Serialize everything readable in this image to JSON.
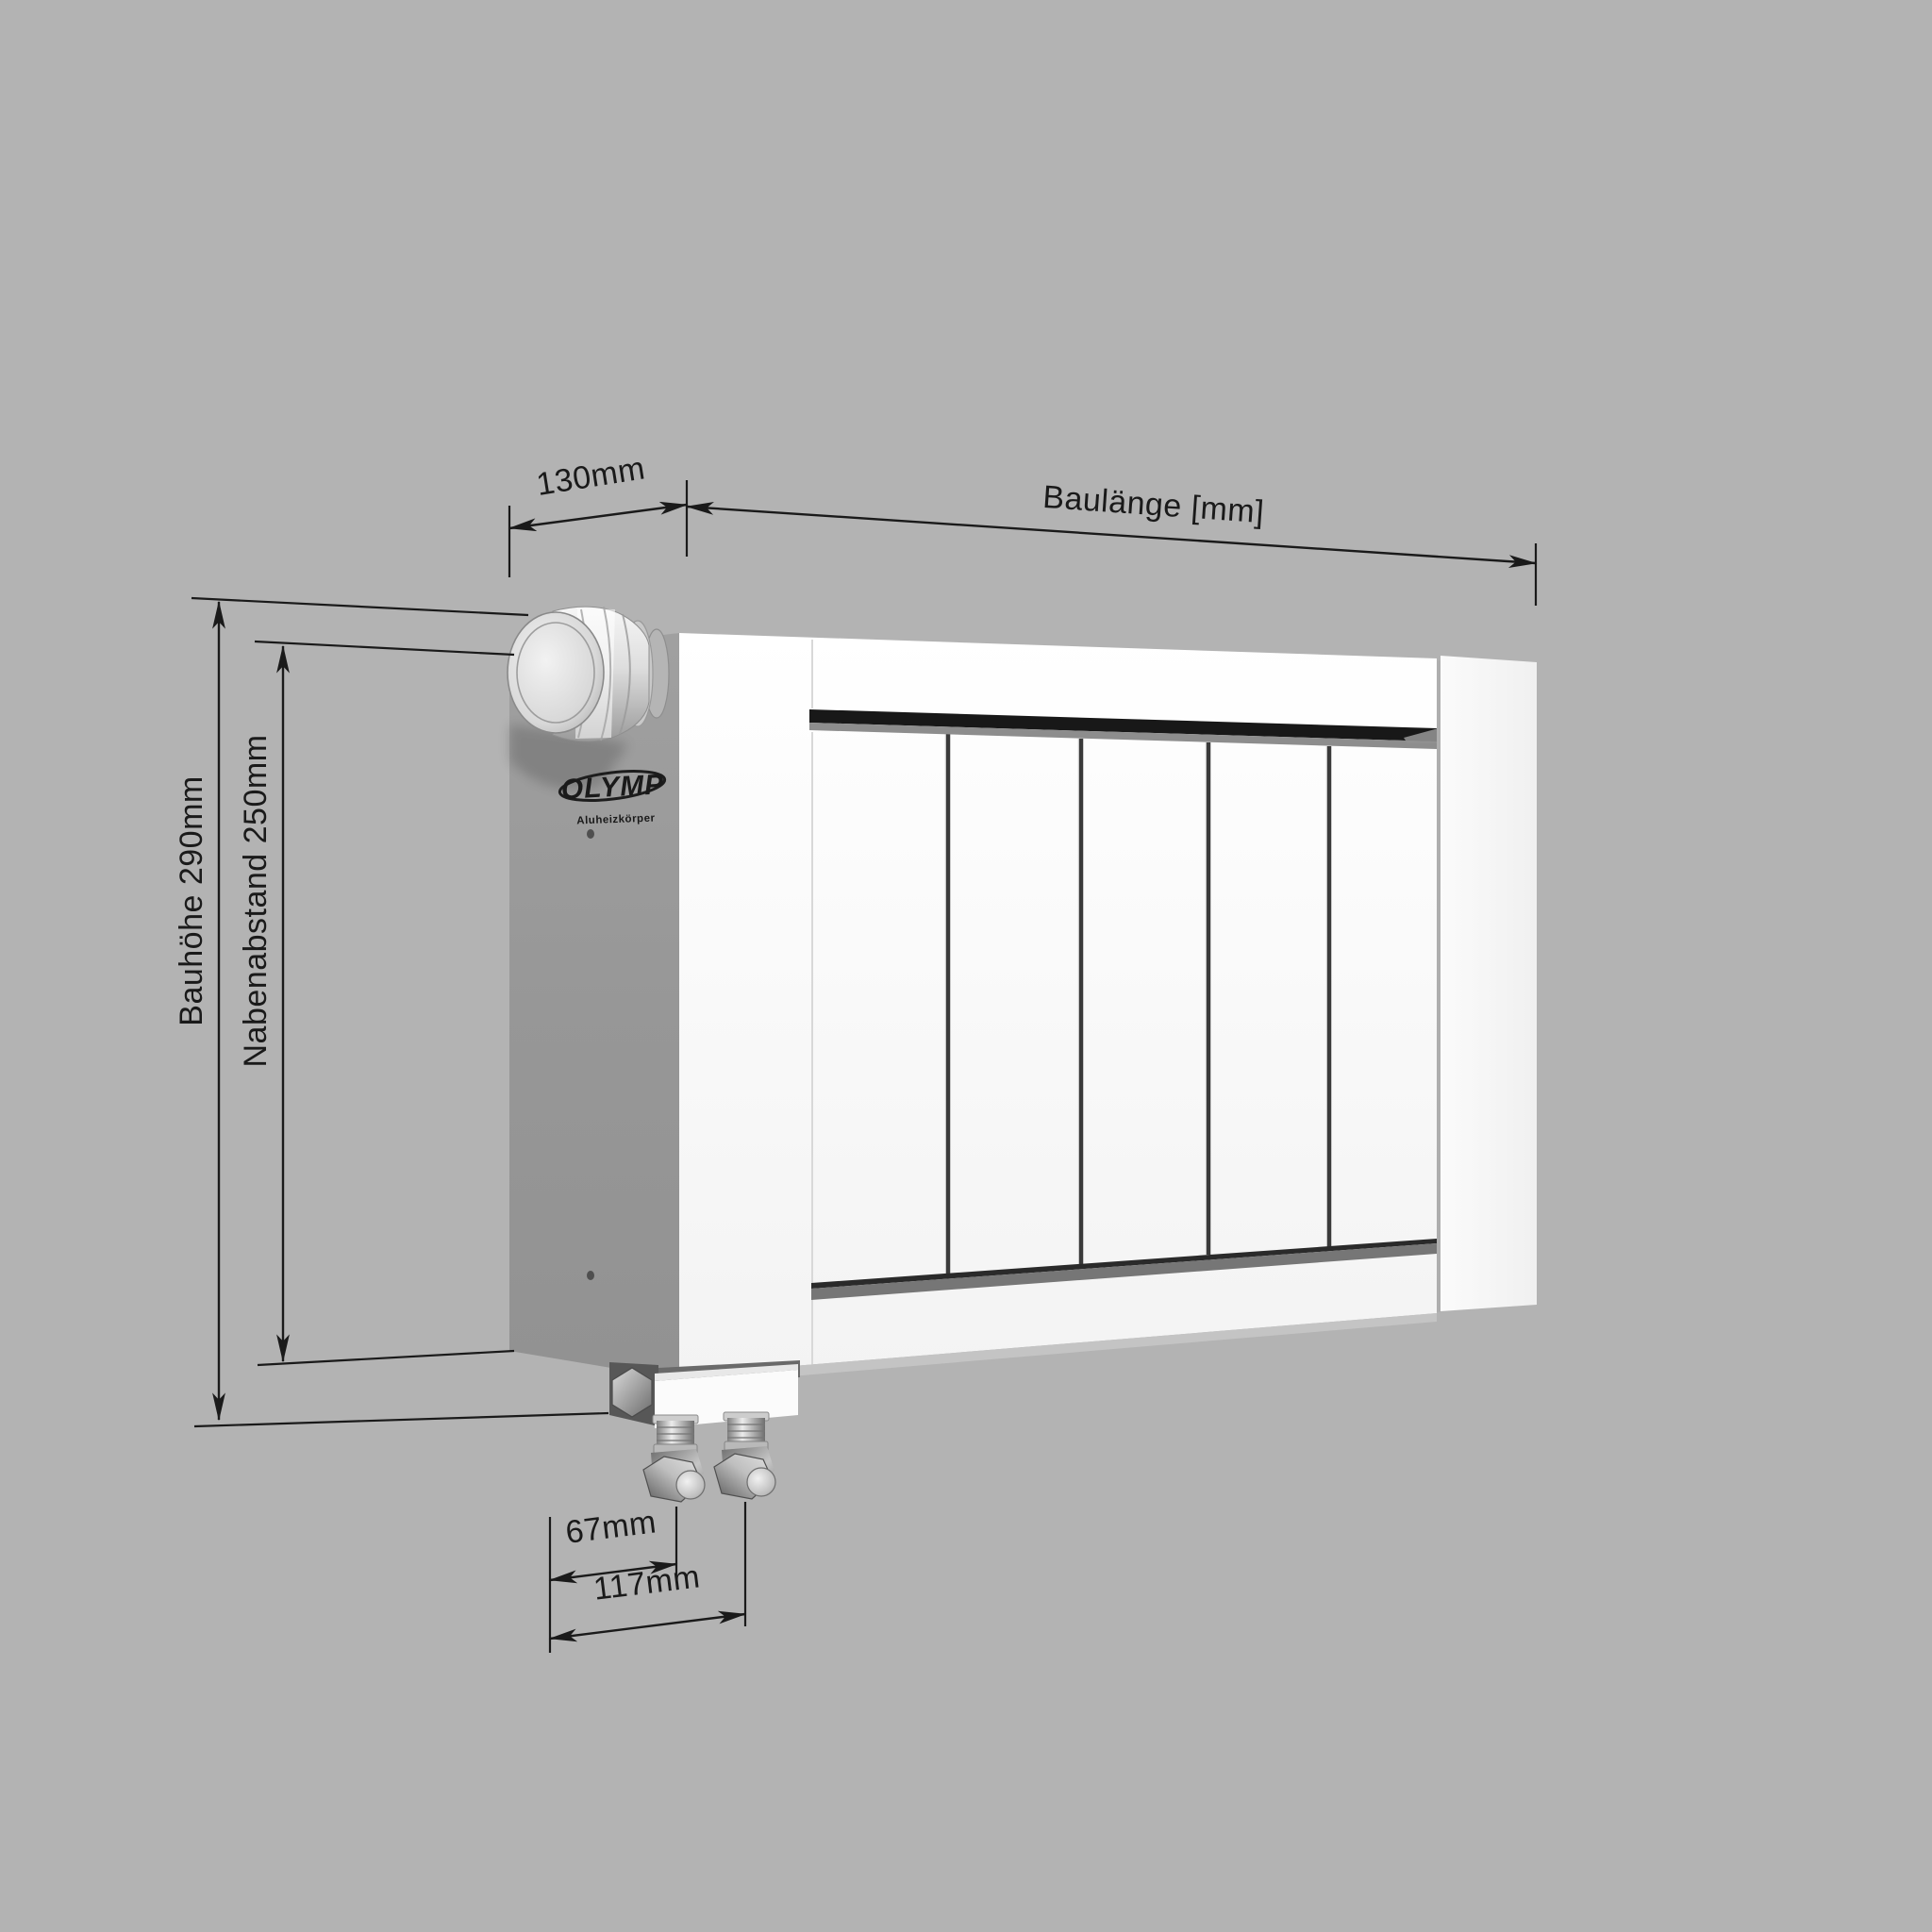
{
  "drawing": {
    "background_color": "#B3B3B3",
    "line_color": "#1A1A1A",
    "annotations": {
      "depth": "130mm",
      "length": "Baulänge [mm]",
      "height": "Bauhöhe 290mm",
      "hub_spacing": "Nabenabstand 250mm",
      "valve_offset_inner": "67mm",
      "valve_offset_outer": "117mm"
    },
    "measurements": {
      "depth_mm": 130,
      "height_mm": 290,
      "hub_spacing_mm": 250,
      "valve_offset_inner_mm": 67,
      "valve_offset_outer_mm": 117
    },
    "logo": {
      "brand": "OLYMP",
      "subtitle": "Aluheizkörper"
    }
  }
}
